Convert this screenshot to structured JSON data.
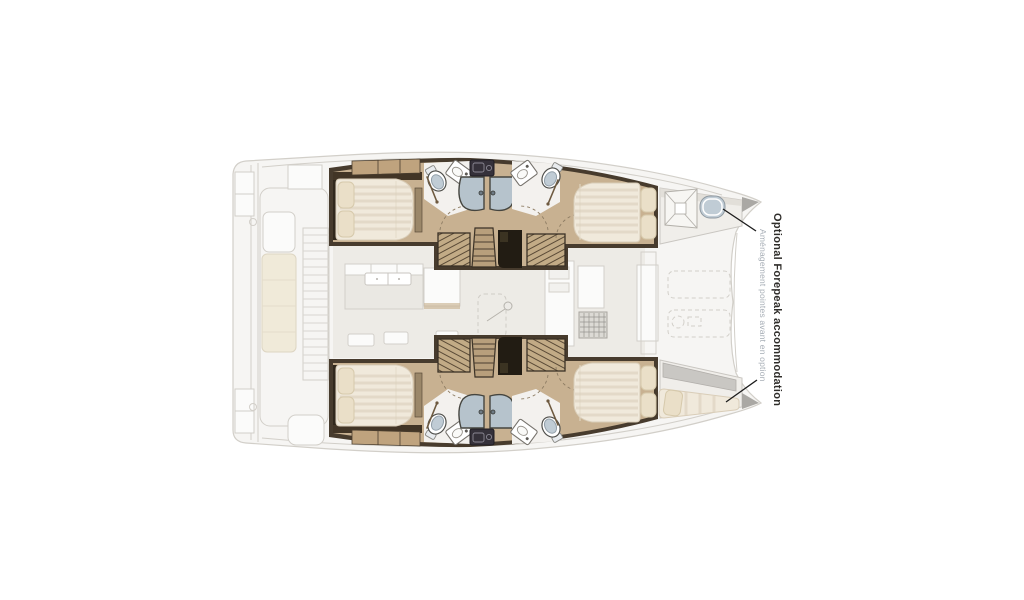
{
  "caption": {
    "title": "Optional Forepeak accommodation",
    "subtitle": "Aménagement pointes avant en option"
  },
  "colors": {
    "wood": "#c8b191",
    "wall": "#473b2d",
    "mattress": "#f0e9db",
    "mattressStripe": "#dbd0bc",
    "pillow": "#eadfc8",
    "shower": "#b6c3cc",
    "seatBlue": "#c0ccd5",
    "hatchWood": "#c2ab86",
    "fadedBg": "#f6f5f3",
    "fadedLine": "#d2cfc9",
    "fadedFurn": "#eae8e3",
    "saloonFloor": "#edebe6",
    "cream": "#f0ead9",
    "labelDark": "#2f2d2a",
    "labelLight": "#a7aeb6",
    "callout": "#1c1c1c",
    "tipGray": "#aaa8a4"
  }
}
